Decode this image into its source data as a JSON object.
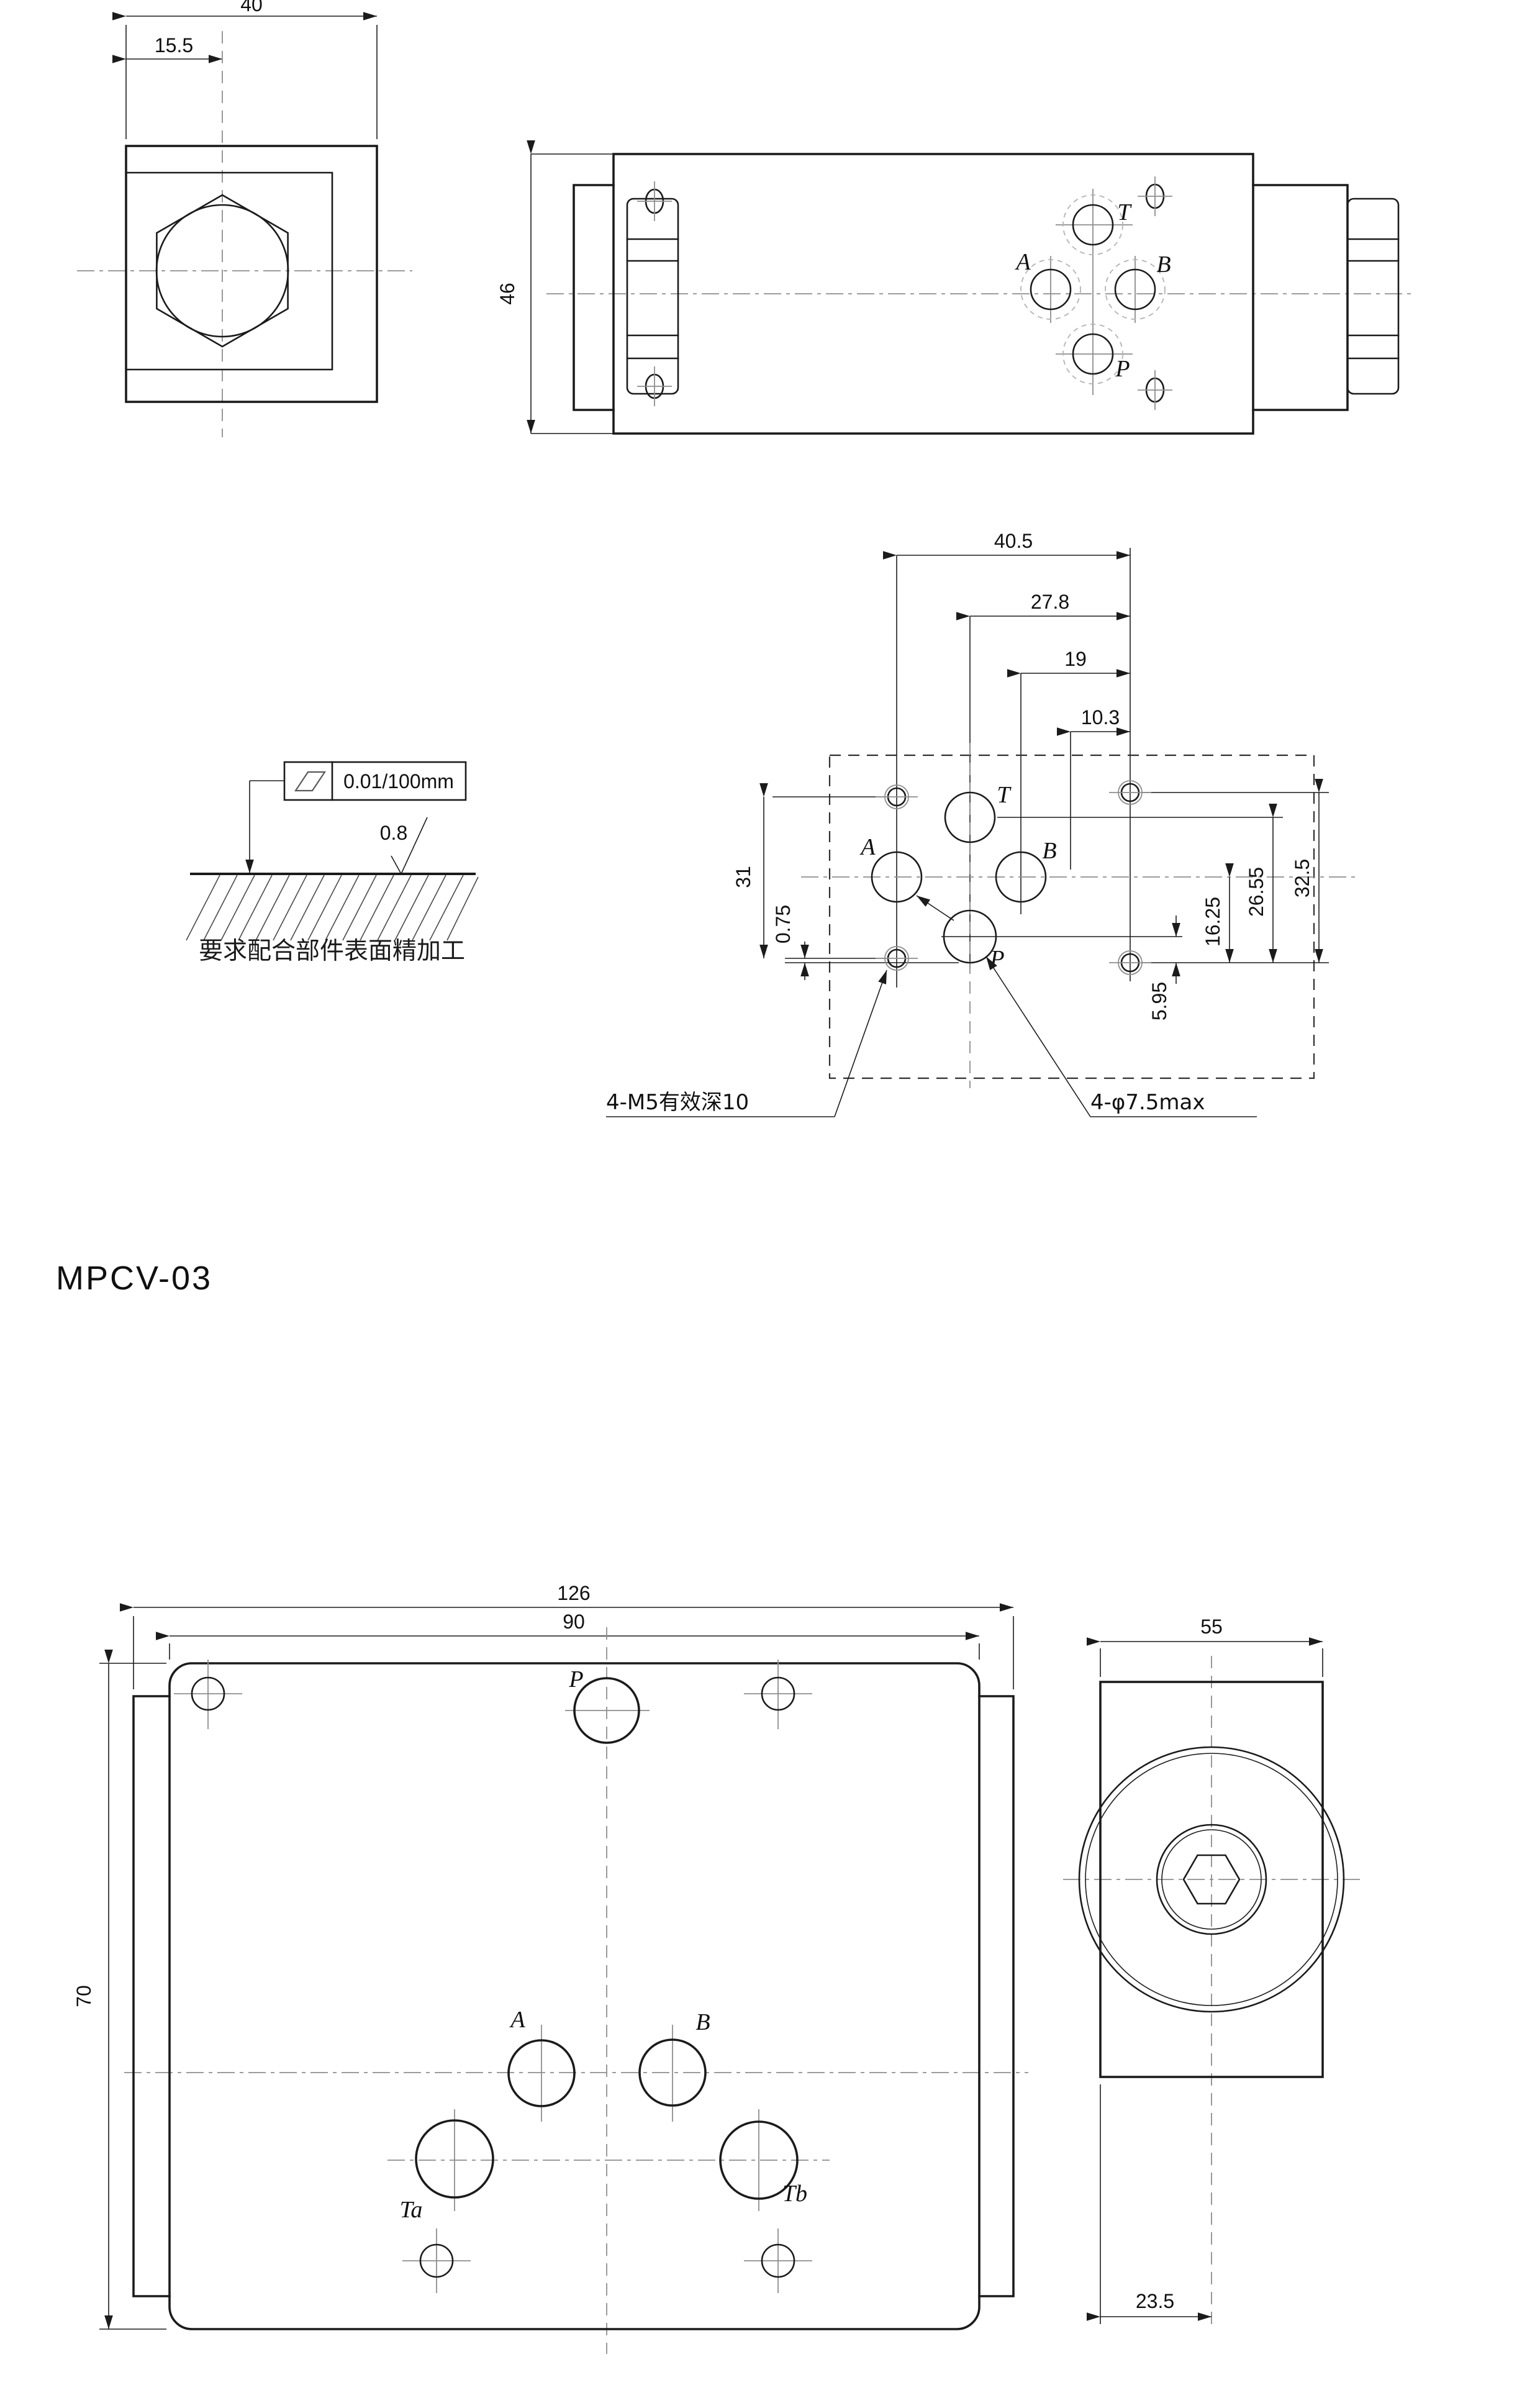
{
  "model_label": "MPCV-03",
  "views": {
    "end_view": {
      "dim_width": "40",
      "dim_center": "15.5"
    },
    "front_view": {
      "dim_height": "46",
      "ports": {
        "t": "T",
        "a": "A",
        "b": "B",
        "p": "P"
      }
    },
    "mounting_view": {
      "dims": {
        "w1": "40.5",
        "w2": "27.8",
        "w3": "19",
        "w4": "10.3",
        "h_left": "31",
        "h_offset": "0.75",
        "h1": "16.25",
        "h2": "26.55",
        "h3": "32.5",
        "h4": "5.95"
      },
      "ports": {
        "t": "T",
        "a": "A",
        "b": "B",
        "p": "P"
      },
      "note_thread": "4-M5有效深10",
      "note_hole": "4-φ7.5max"
    },
    "surface_spec": {
      "flatness": "0.01/100mm",
      "roughness": "0.8",
      "caption": "要求配合部件表面精加工"
    },
    "bottom_view": {
      "dims": {
        "overall": "126",
        "body": "90",
        "height": "70"
      },
      "ports": {
        "p": "P",
        "a": "A",
        "b": "B",
        "ta": "Ta",
        "tb": "Tb"
      }
    },
    "side_view": {
      "dims": {
        "width": "55",
        "center": "23.5"
      }
    }
  }
}
